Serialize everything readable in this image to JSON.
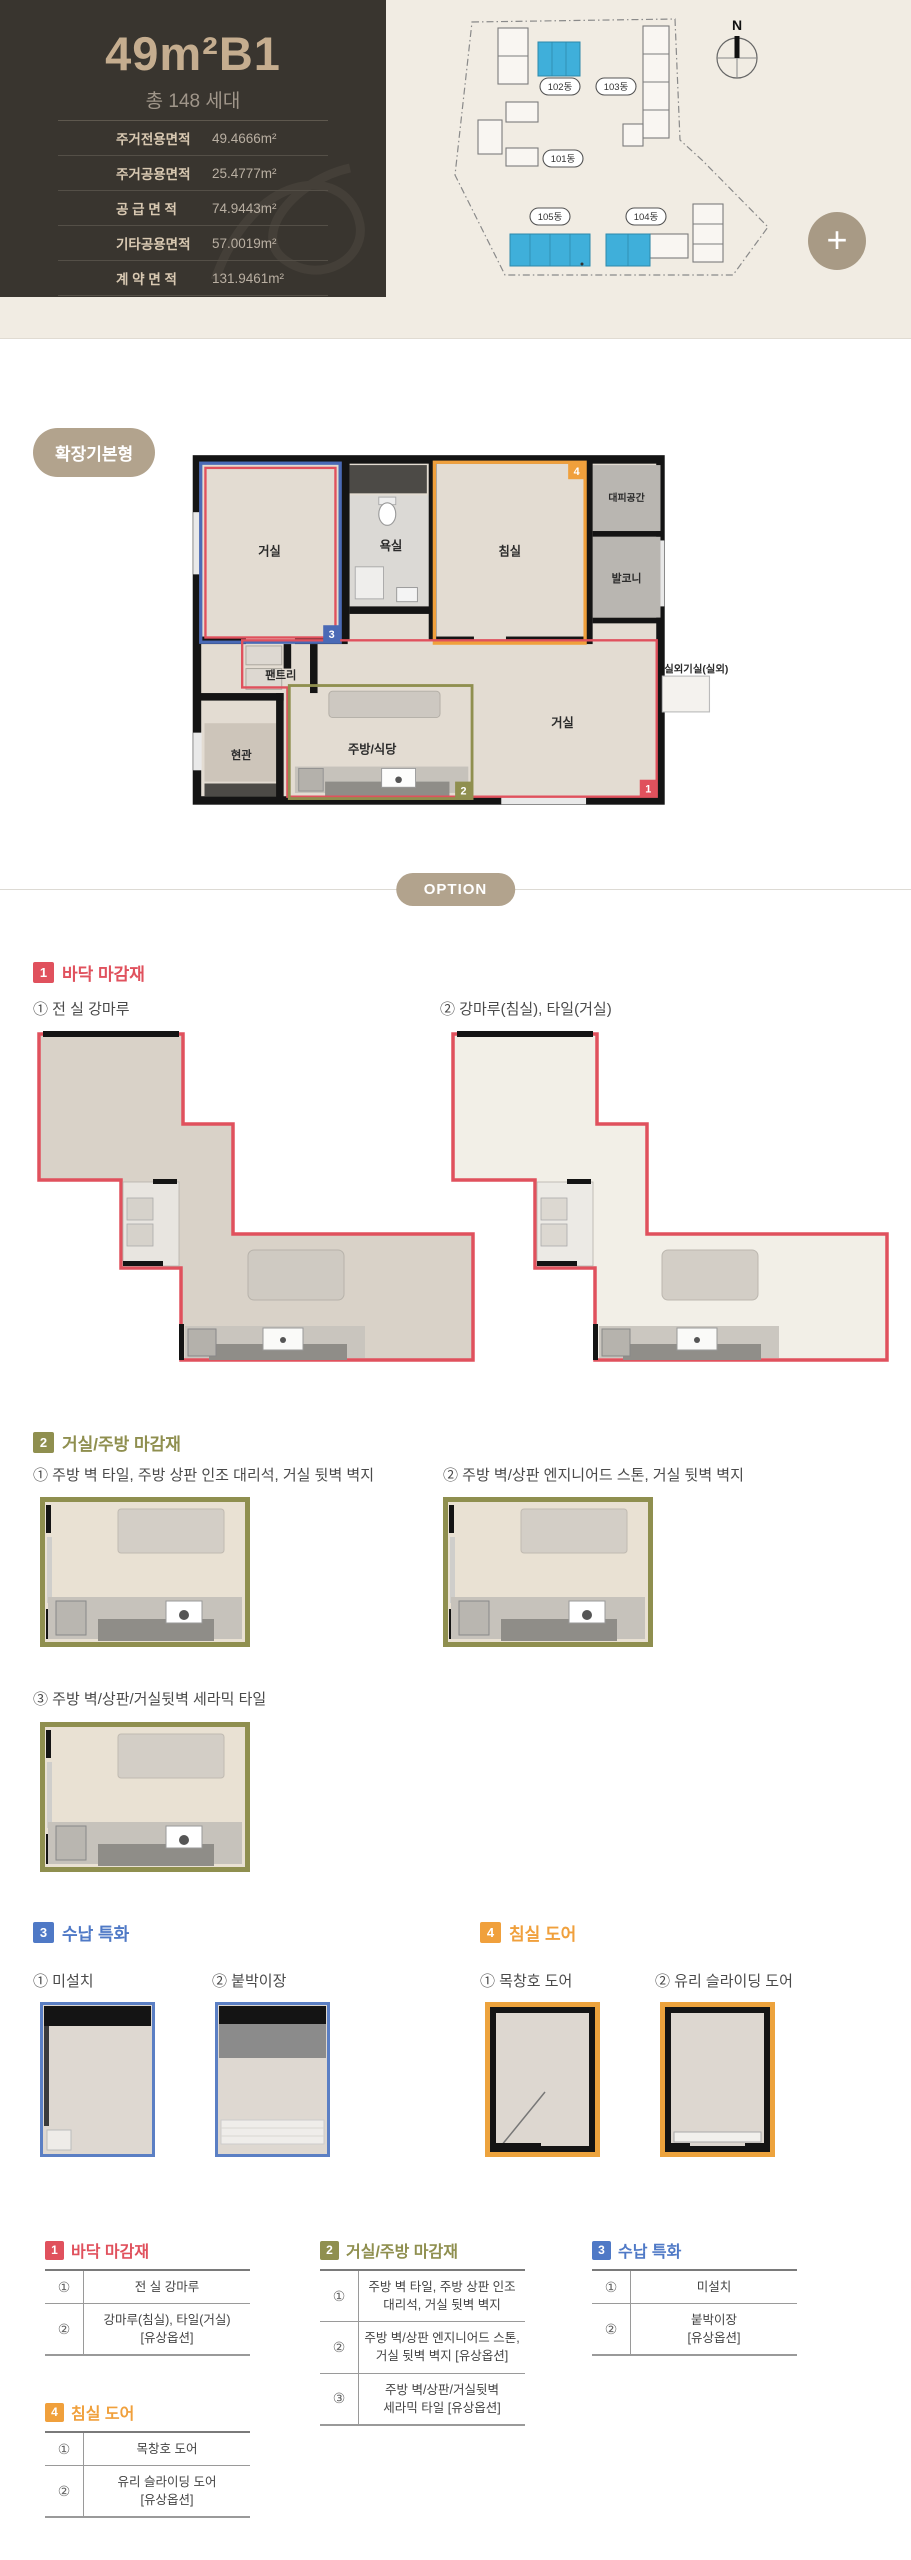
{
  "header": {
    "title": "49m²B1",
    "subtitle": "총 148 세대",
    "specs": [
      {
        "label": "주거전용면적",
        "value": "49.4666m²"
      },
      {
        "label": "주거공용면적",
        "value": "25.4777m²"
      },
      {
        "label": "공 급 면 적",
        "value": "74.9443m²"
      },
      {
        "label": "기타공용면적",
        "value": "57.0019m²"
      },
      {
        "label": "계 약 면 적",
        "value": "131.9461m²"
      }
    ],
    "site_plan": {
      "compass": "N",
      "buildings": [
        {
          "label": "102동"
        },
        {
          "label": "103동"
        },
        {
          "label": "101동"
        },
        {
          "label": "105동"
        },
        {
          "label": "104동"
        }
      ],
      "highlight_color": "#3fafda",
      "plus_label": "+"
    }
  },
  "plan": {
    "badge": "확장기본형",
    "rooms": {
      "living1": "거실",
      "bath": "욕실",
      "bedroom": "침실",
      "shelter": "대피공간",
      "balcony": "발코니",
      "pantry": "팬트리",
      "entrance": "현관",
      "kitchen": "주방/식당",
      "living2": "거실",
      "outdoor": "실외기실(실외)"
    },
    "tags": [
      "1",
      "2",
      "3",
      "4"
    ]
  },
  "option_divider": "OPTION",
  "colors": {
    "section1": "#e0515d",
    "section2": "#8f8f4f",
    "section3": "#4f79c6",
    "section4": "#f0a03c",
    "badge": "#b2a38d",
    "building_highlight": "#3fafda"
  },
  "sections": [
    {
      "num": "1",
      "title": "바닥 마감재",
      "options": [
        "① 전 실 강마루",
        "② 강마루(침실), 타일(거실)"
      ]
    },
    {
      "num": "2",
      "title": "거실/주방 마감재",
      "options": [
        "① 주방 벽 타일, 주방 상판 인조 대리석, 거실 뒷벽 벽지",
        "② 주방 벽/상판 엔지니어드 스톤, 거실 뒷벽 벽지",
        "③ 주방 벽/상판/거실뒷벽 세라믹 타일"
      ]
    },
    {
      "num": "3",
      "title": "수납 특화",
      "options": [
        "① 미설치",
        "② 붙박이장"
      ]
    },
    {
      "num": "4",
      "title": "침실 도어",
      "options": [
        "① 목창호 도어",
        "② 유리 슬라이딩 도어"
      ]
    }
  ],
  "tables": [
    {
      "num": "1",
      "title": "바닥 마감재",
      "rows": [
        {
          "n": "①",
          "text": "전 실 강마루"
        },
        {
          "n": "②",
          "text": "강마루(침실), 타일(거실)\n[유상옵션]"
        }
      ]
    },
    {
      "num": "2",
      "title": "거실/주방 마감재",
      "rows": [
        {
          "n": "①",
          "text": "주방 벽 타일, 주방 상판 인조\n대리석, 거실 뒷벽 벽지"
        },
        {
          "n": "②",
          "text": "주방 벽/상판 엔지니어드 스톤,\n거실 뒷벽 벽지 [유상옵션]"
        },
        {
          "n": "③",
          "text": "주방 벽/상판/거실뒷벽\n세라믹 타일 [유상옵션]"
        }
      ]
    },
    {
      "num": "3",
      "title": "수납 특화",
      "rows": [
        {
          "n": "①",
          "text": "미설치"
        },
        {
          "n": "②",
          "text": "붙박이장\n[유상옵션]"
        }
      ]
    },
    {
      "num": "4",
      "title": "침실 도어",
      "rows": [
        {
          "n": "①",
          "text": "목창호 도어"
        },
        {
          "n": "②",
          "text": "유리 슬라이딩 도어\n[유상옵션]"
        }
      ]
    }
  ]
}
